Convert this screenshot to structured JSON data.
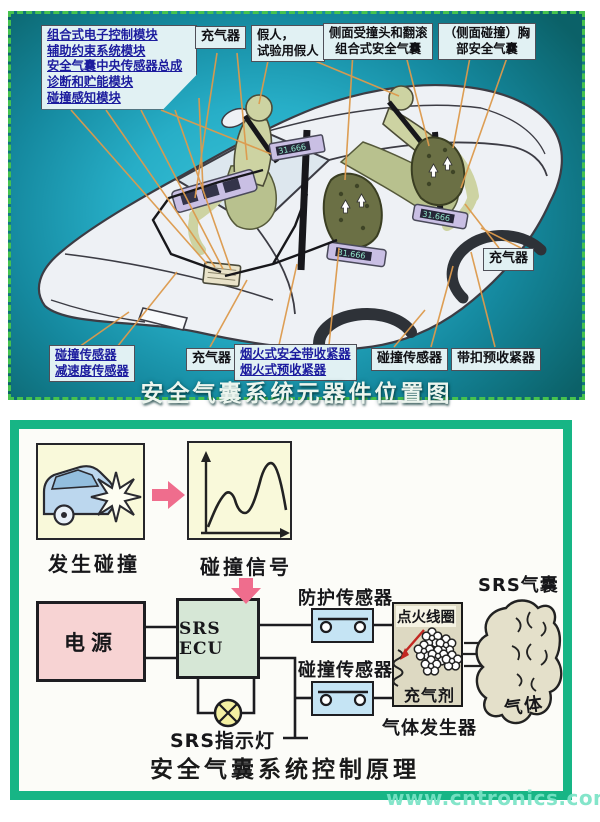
{
  "top_panel": {
    "title": "安全气囊系统元器件位置图",
    "module_box": {
      "lines": [
        "组合式电子控制模块",
        "辅助约束系统模块",
        "安全气囊中央传感器总成",
        "诊断和贮能模块",
        "碰撞感知模块"
      ]
    },
    "inflator_top": "充气器",
    "dummy_box": {
      "line1": "假人，",
      "line2": "试验用假人"
    },
    "side_airbag_box": {
      "line1": "侧面受撞头和翻滚",
      "line2": "组合式安全气囊"
    },
    "chest_airbag_box": {
      "line1": "（侧面碰撞）胸",
      "line2": "部安全气囊"
    },
    "inflator_right": "充气器",
    "crash_decel_box": {
      "line1": "碰撞传感器",
      "line2": "减速度传感器"
    },
    "inflator_bottom": "充气器",
    "pyro_box": {
      "line1": "烟火式安全带收紧器",
      "line2": "烟火式预收紧器"
    },
    "crash_sensor_bottom": "碰撞传感器",
    "buckle_pretensioner": "带扣预收紧器",
    "module_digits": "31.666"
  },
  "bottom_panel": {
    "title": "安全气囊系统控制原理",
    "crash_caption": "发生碰撞",
    "signal_caption": "碰撞信号",
    "power_box": "电源",
    "ecu_box": "SRS ECU",
    "indicator_lamp": "SRS指示灯",
    "safing_sensor": "防护传感器",
    "crash_sensor": "碰撞传感器",
    "ignition_coil": "点火线圈",
    "inflation_agent": "充气剂",
    "gas_generator": "气体发生器",
    "srs_airbag": "SRS气囊",
    "gas": "气体"
  },
  "watermark": "www.cntronics.com",
  "colors": {
    "panel_teal": "#27aec7",
    "top_border_green": "#46c24e",
    "bottom_border_green": "#17b585",
    "leader_orange": "#dd9a4c",
    "arrow_pink": "#ef6d8d",
    "label_blue": "#1c1c9e",
    "watermark_green": "#79e3c5"
  }
}
